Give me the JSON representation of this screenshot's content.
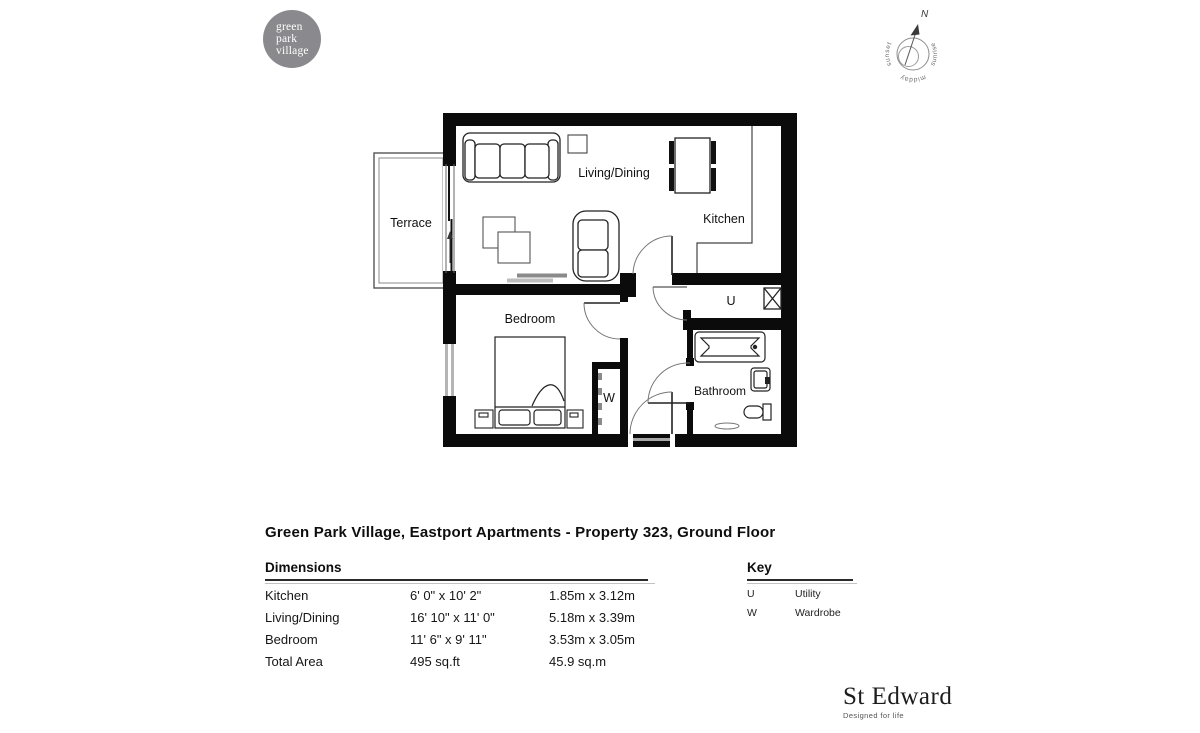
{
  "logo": {
    "lines": [
      "green",
      "park",
      "village"
    ],
    "bg_color": "#8a8a8e"
  },
  "compass": {
    "north": "N",
    "sunset": "sunset",
    "sunrise": "sunrise",
    "midday": "midday"
  },
  "floorplan": {
    "wall_color": "#0b0b0b",
    "labels": {
      "terrace": "Terrace",
      "living_dining": "Living/Dining",
      "kitchen": "Kitchen",
      "bedroom": "Bedroom",
      "bathroom": "Bathroom",
      "utility_symbol": "U",
      "wardrobe_symbol": "W"
    }
  },
  "title": "Green Park Village, Eastport Apartments - Property 323, Ground Floor",
  "dimensions": {
    "heading": "Dimensions",
    "rows": [
      {
        "room": "Kitchen",
        "imperial": "6' 0\" x 10' 2\"",
        "metric": "1.85m x 3.12m"
      },
      {
        "room": "Living/Dining",
        "imperial": "16' 10\" x 11' 0\"",
        "metric": "5.18m x 3.39m"
      },
      {
        "room": "Bedroom",
        "imperial": "11' 6\" x 9' 11\"",
        "metric": "3.53m x 3.05m"
      },
      {
        "room": "Total Area",
        "imperial": "495 sq.ft",
        "metric": "45.9 sq.m"
      }
    ]
  },
  "key": {
    "heading": "Key",
    "rows": [
      {
        "symbol": "U",
        "label": "Utility"
      },
      {
        "symbol": "W",
        "label": "Wardrobe"
      }
    ]
  },
  "brand": {
    "name": "St Edward",
    "tagline": "Designed for life"
  }
}
